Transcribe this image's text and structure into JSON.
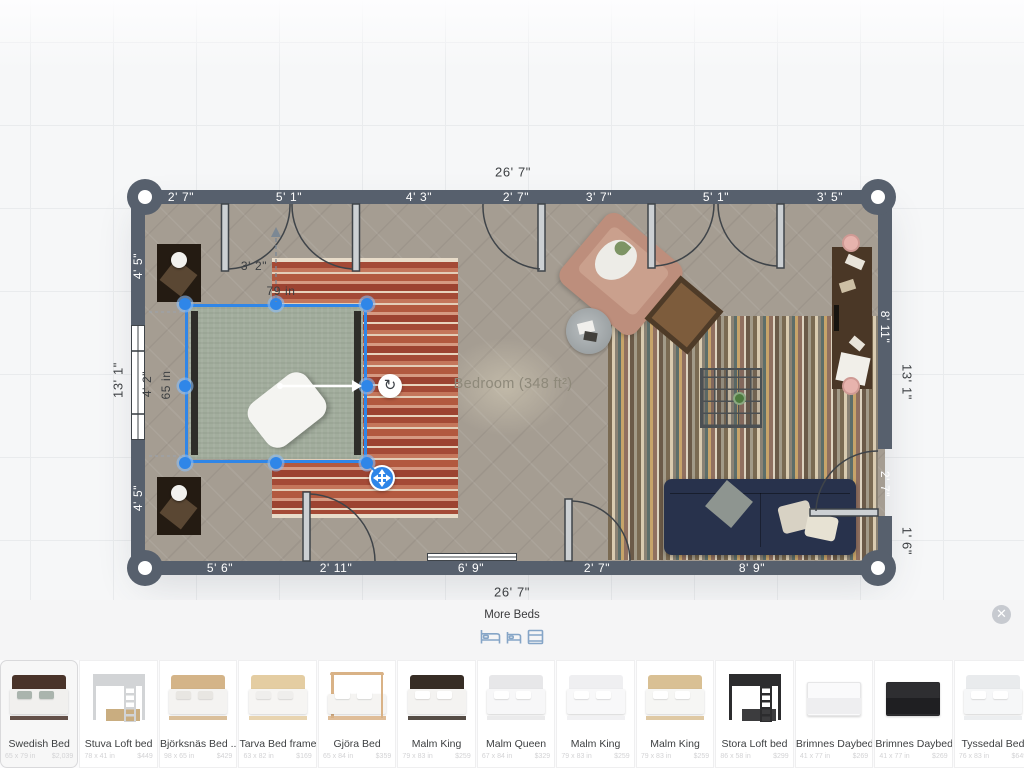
{
  "colors": {
    "selection_blue": "#2f86e8",
    "wall": "#57606d",
    "floor": "#a59d92",
    "sofa_navy": "#28324c",
    "bed_green": "#a2ad9d",
    "panel_icon_blue": "#85a5c7"
  },
  "plan": {
    "room_label": "Bedroom (348 ft²)",
    "top_total": "26' 7\"",
    "bottom_total": "26' 7\"",
    "left_total": "13' 1\"",
    "right_total": "13' 1\"",
    "right_lower": "1' 6\"",
    "top_segments": [
      "2' 7\"",
      "5' 1\"",
      "4' 3\"",
      "2' 7\"",
      "3' 7\"",
      "5' 1\"",
      "3' 5\""
    ],
    "bottom_segments": [
      "5' 6\"",
      "2' 11\"",
      "6' 9\"",
      "2' 7\"",
      "8' 9\""
    ],
    "left_segments": [
      "4' 5\"",
      "4' 2\"",
      "4' 5\""
    ],
    "right_segments": [
      "8' 11\"",
      "2' 7\""
    ],
    "selection": {
      "width": "79 in",
      "depth": "65 in",
      "gap": "3' 2\""
    }
  },
  "panel": {
    "title": "More Beds",
    "items": [
      {
        "name": "Swedish Bed",
        "dims": "65 x 79 in",
        "price": "$2,039",
        "variant": "bed",
        "frame": "#4a342a",
        "bedding": "#f1f0ee",
        "pillow": "#aab4ad",
        "selected": true
      },
      {
        "name": "Stuva Loft bed",
        "dims": "78 x 41 in",
        "price": "$449",
        "variant": "loft",
        "frame": "#d2d4d6",
        "bedding": "#c9ad80"
      },
      {
        "name": "Björksnäs Bed ...",
        "dims": "98 x 65 in",
        "price": "$429",
        "variant": "bed",
        "frame": "#d4b488",
        "bedding": "#f4f3f1",
        "pillow": "#e8e6e2"
      },
      {
        "name": "Tarva Bed frame",
        "dims": "63 x 82 in",
        "price": "$169",
        "variant": "bed",
        "frame": "#e4cda2",
        "bedding": "#f6f5f3",
        "pillow": "#efeeec"
      },
      {
        "name": "Gjöra Bed",
        "dims": "65 x 84 in",
        "price": "$359",
        "variant": "poster",
        "frame": "#d9b286",
        "bedding": "#f5f4f2"
      },
      {
        "name": "Malm King",
        "dims": "79 x 83 in",
        "price": "$259",
        "variant": "bed",
        "frame": "#372d25",
        "bedding": "#f4f3f1",
        "pillow": "#ffffff"
      },
      {
        "name": "Malm Queen",
        "dims": "67 x 84 in",
        "price": "$329",
        "variant": "bed",
        "frame": "#e7e7e9",
        "bedding": "#f7f7f8",
        "pillow": "#ffffff"
      },
      {
        "name": "Malm King",
        "dims": "79 x 83 in",
        "price": "$259",
        "variant": "bed",
        "frame": "#efeff1",
        "bedding": "#f8f8f9",
        "pillow": "#ffffff"
      },
      {
        "name": "Malm King",
        "dims": "79 x 83 in",
        "price": "$259",
        "variant": "bed",
        "frame": "#d9c094",
        "bedding": "#f6f6f4",
        "pillow": "#ffffff"
      },
      {
        "name": "Stora Loft bed",
        "dims": "86 x 58 in",
        "price": "$299",
        "variant": "loft-dark",
        "frame": "#2c2c2e",
        "bedding": "#3c3c3e"
      },
      {
        "name": "Brimnes Daybed",
        "dims": "41 x 77 in",
        "price": "$269",
        "variant": "daybed",
        "frame": "#eeeef0",
        "bedding": "#fafafb"
      },
      {
        "name": "Brimnes Daybed",
        "dims": "41 x 77 in",
        "price": "$269",
        "variant": "daybed",
        "frame": "#1f1f22",
        "bedding": "#2e2e31"
      },
      {
        "name": "Tyssedal Bed",
        "dims": "76 x 83 in",
        "price": "$649",
        "variant": "bed",
        "frame": "#e9ebed",
        "bedding": "#f6f7f8",
        "pillow": "#ffffff"
      }
    ]
  }
}
